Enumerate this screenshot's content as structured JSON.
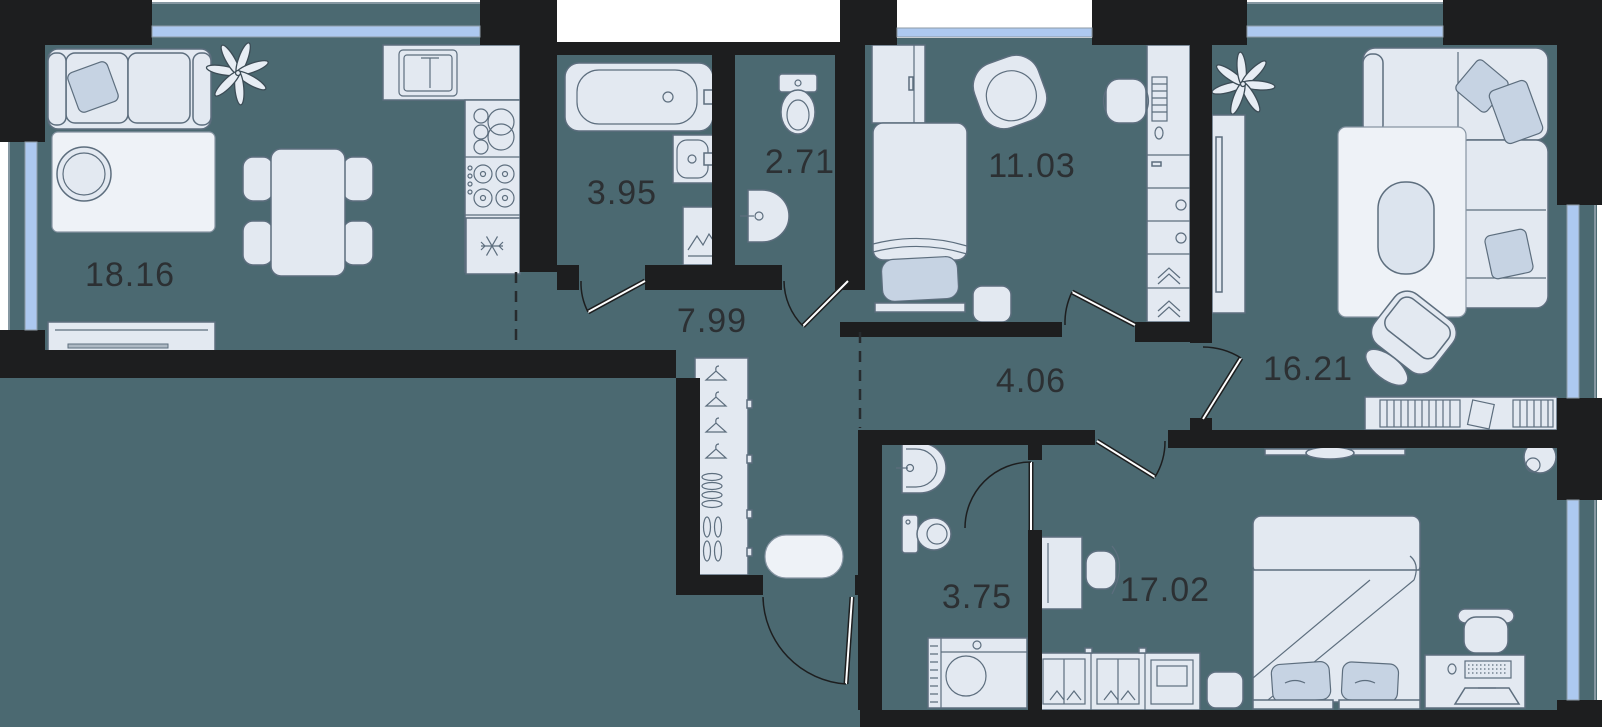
{
  "floorplan": {
    "rooms": [
      {
        "id": "living-dining",
        "area": "18.16"
      },
      {
        "id": "bathroom",
        "area": "3.95"
      },
      {
        "id": "wc",
        "area": "2.71"
      },
      {
        "id": "bedroom",
        "area": "11.03"
      },
      {
        "id": "living-room",
        "area": "16.21"
      },
      {
        "id": "hallway",
        "area": "7.99"
      },
      {
        "id": "corridor",
        "area": "4.06"
      },
      {
        "id": "shower-room",
        "area": "3.75"
      },
      {
        "id": "bedroom-master",
        "area": "17.02"
      }
    ],
    "colors": {
      "background": "#ffffff",
      "floor": "#4b6971",
      "wall": "#1d1e1f",
      "window": "#adc9f0",
      "furniture_fill": "#e3e9f1",
      "furniture_stroke": "#5d6e7e",
      "accent_rug": "#eef2f7",
      "label": "#2c3033"
    }
  }
}
